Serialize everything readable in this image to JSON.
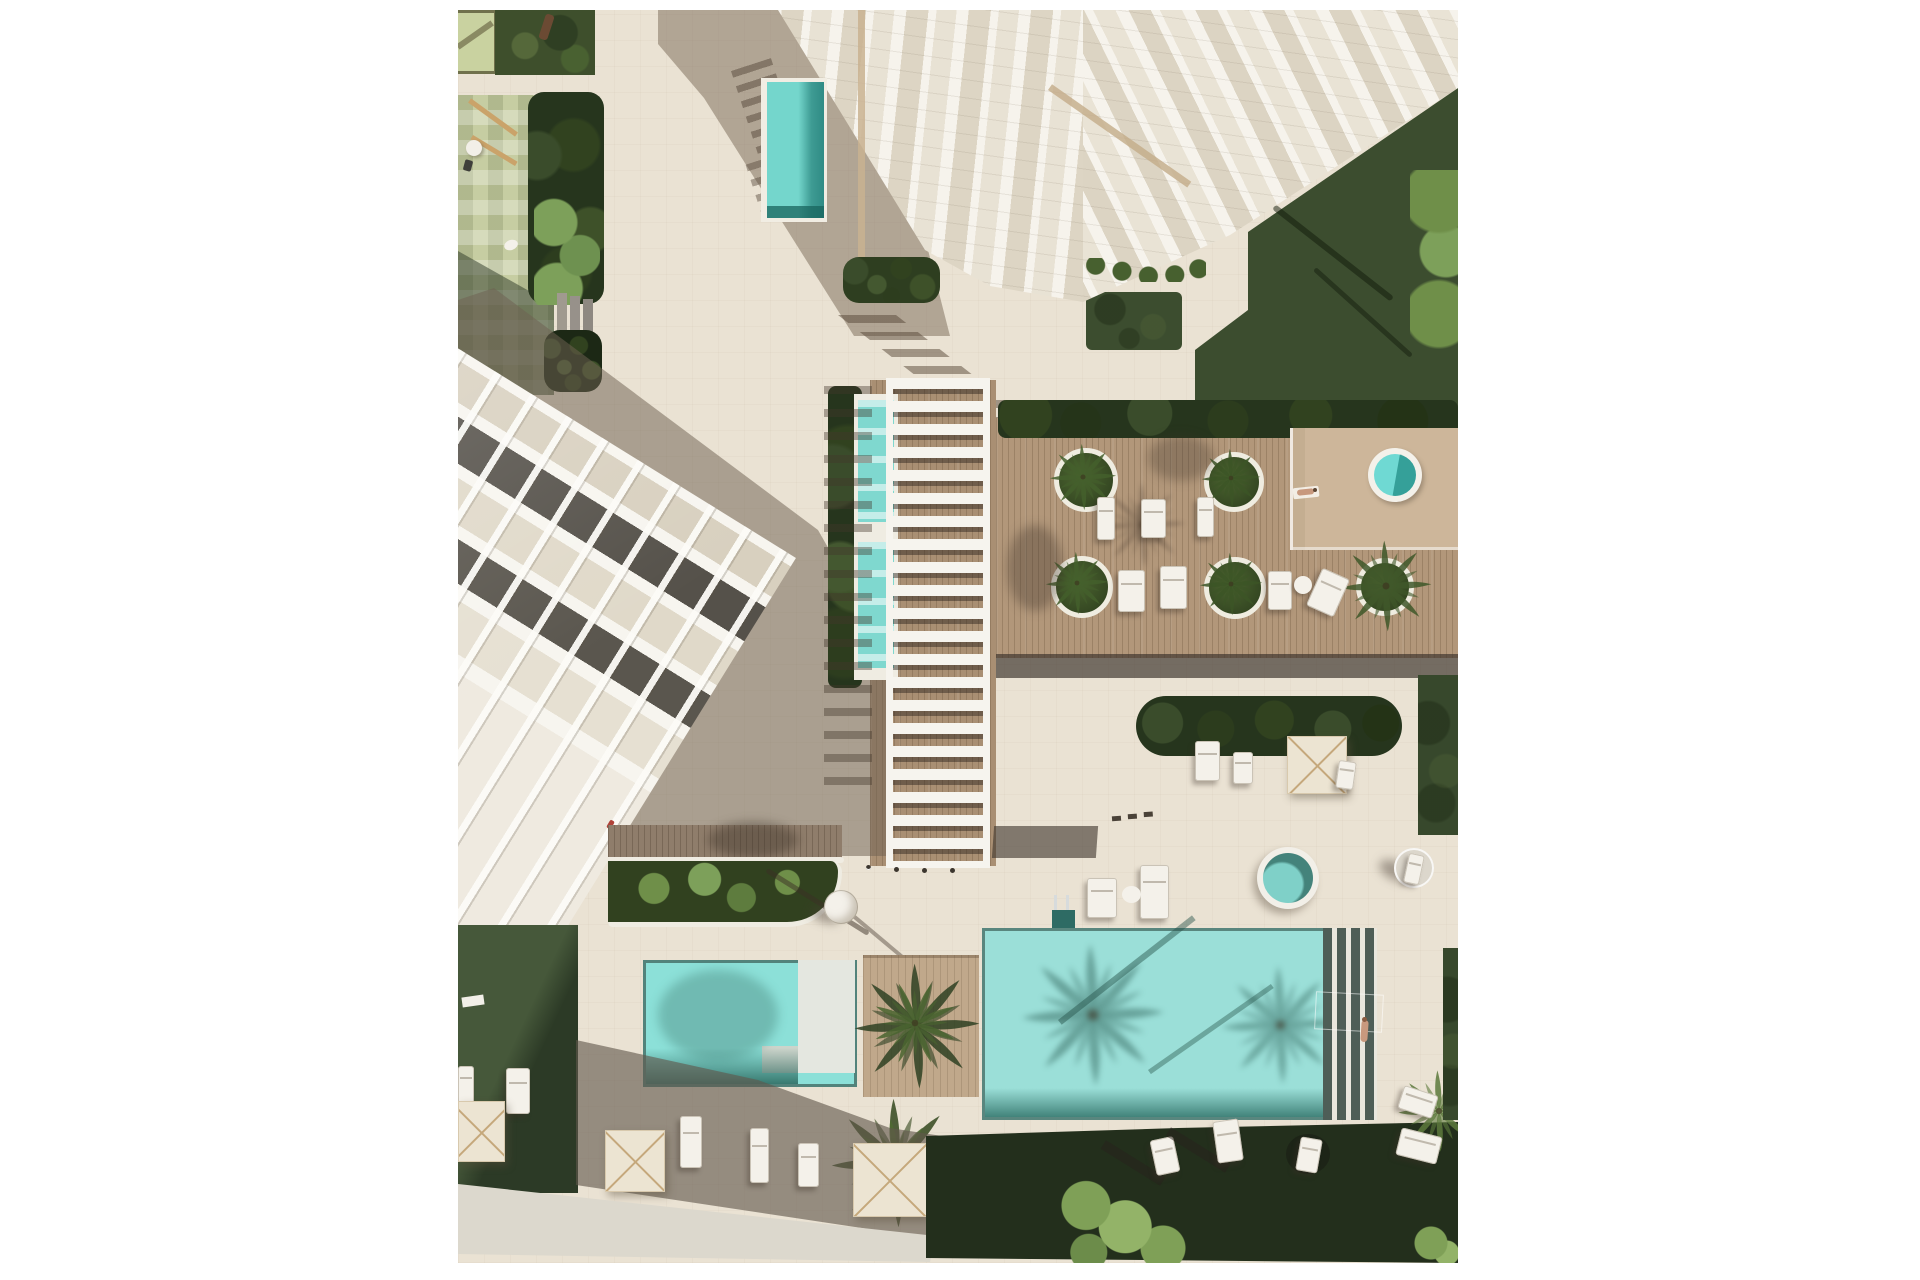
{
  "scene": {
    "kind": "aerial top-down architectural rendering",
    "setting": "residential resort courtyard with swimming pools and sun decks",
    "buildings": [
      "apartment-tower-top",
      "terraced-apartment-block-left"
    ],
    "water_features": [
      "lap-pool-by-tower",
      "pergola-plunge-pools",
      "main-pool",
      "kids-pool-with-sun-shelf",
      "deck-hot-tub",
      "plaza-hot-tub"
    ],
    "landscape": [
      "playground",
      "lawns",
      "hedges",
      "palm-trees",
      "round-planters",
      "shrub-beds"
    ],
    "furniture": [
      "sun-loungers",
      "square-parasols",
      "round-table",
      "round-daybed",
      "benches",
      "pool-ladder"
    ],
    "people": [
      {
        "where": "deck-edge",
        "pose": "sunbathing"
      },
      {
        "where": "main-pool",
        "pose": "swimming"
      },
      {
        "where": "boardwalk",
        "pose": "walking"
      }
    ],
    "counts": {
      "round_planters": 5,
      "square_parasols": 4,
      "pergola_slats": 21,
      "sun_loungers": 20,
      "hot_tubs": 2,
      "pools": 4,
      "buildings": 2
    },
    "colors": {
      "pavement": "#eae2d3",
      "deck": "#b2977a",
      "walkway": "#8f7d6b",
      "wood-path": "#a4906f",
      "white": "#f6f4ee",
      "glass": "#d9d1c0",
      "dark-facade": "#56524a",
      "shadow": "#6f6457",
      "pool": "#9bdfd8",
      "pool-deep": "#44837b",
      "pool-small": "#8ce0d8",
      "lap-pool": "#5ecfc6",
      "plunge": "#7fd8cf",
      "hot-tub": "#62d4cd",
      "grass": "#46583a",
      "grass-dark": "#2c3a26",
      "lawn": "#3c4d2f",
      "hedge": "#26351d",
      "leaf": "#7f9e5a",
      "planter-box": "#c0a88b",
      "checker": "#c6cda2",
      "playground": "#c9d2a0",
      "umbrella": "#ece4d2",
      "ribs": "#c5a87b",
      "skin": "#c8997e",
      "red": "#b04238",
      "chrome": "#d7dbdc",
      "path": "#dcd8cd"
    }
  }
}
